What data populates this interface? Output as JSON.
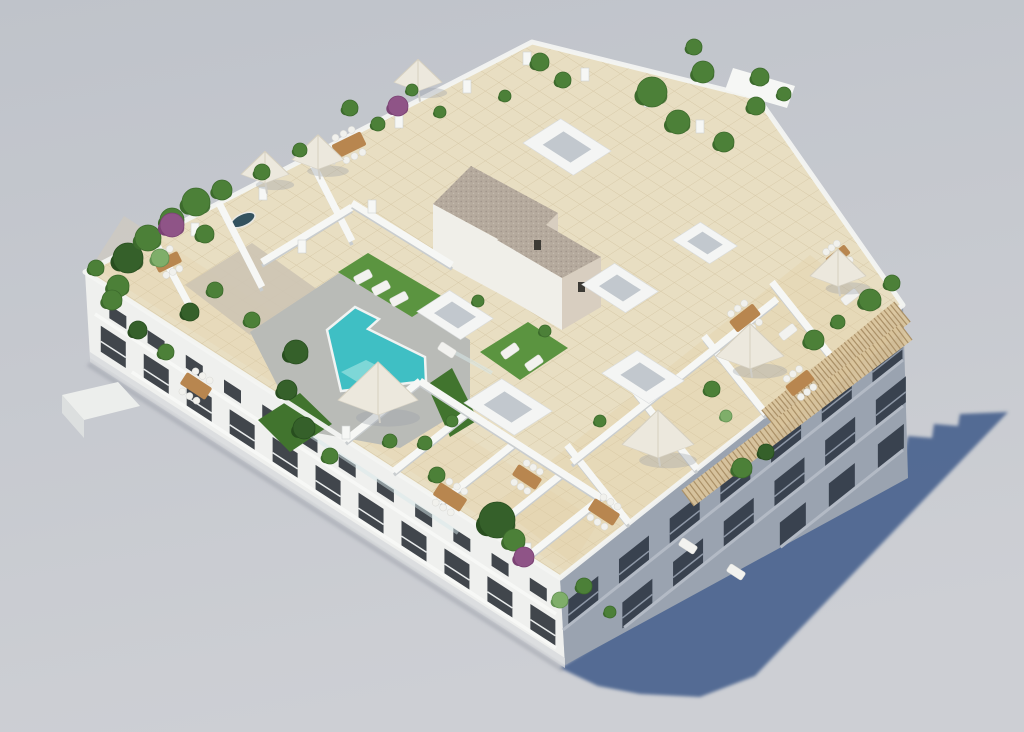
{
  "scene_meta": {
    "subject": "aerial 3d render of white apartment block with rooftop terraces and pool",
    "width": 1024,
    "height": 732
  },
  "colors": {
    "bg_top": "#bfc3ca",
    "bg_bottom": "#cdcfd4",
    "shadow": "#4d6590",
    "roof_tile": "#e8dec2",
    "tile_line": "#c7b48d",
    "front_band": "#e3d1a8",
    "right_band": "#e0cda2",
    "garden_gravel": "#cdc4b4",
    "deck": "#b9bbb7",
    "pool": "#3fbfc4",
    "pool_steps": "#8adada",
    "pool_coping": "#f1f3f2",
    "glass": "#d7e7e9",
    "grass": "#5b9440",
    "grass_dark": "#41742e",
    "wall_white": "#f6f7f5",
    "wall_shade": "#c9cdcf",
    "parapet": "#f3f4f2",
    "facade_front": "#eff0ee",
    "facade_se": "#9aa3b0",
    "facade_band_front": "#f7f8f6",
    "facade_band_se": "#b3bac5",
    "window_dark": "#41464c",
    "window_se": "#39424f",
    "rail_front": "#e9ecec",
    "rail_se": "#8d97a6",
    "plinth": "#d8dadd",
    "ao": "#8f949d",
    "gravel": "#b5aa9d",
    "gravel_dot": "#a0948a",
    "stair_wall": "#f0efe9",
    "stair_wall_warm": "#d8cec0",
    "stair_window": "#3c3a35",
    "pergola_wood": "#d9c49c",
    "pergola_slat": "#ab9168",
    "umbrella": "#ece8dd",
    "umbrella_rib": "#d6d0c0",
    "umbrella_shadow": "#9aa0a8",
    "table_wood": "#b8864f",
    "chair_white": "#f1f1ed",
    "lounger": "#f2f2ef",
    "skylight_top": "#f4f5f4",
    "skylight_inner": "#c2c8ce",
    "plant_green": "#4c8038",
    "plant_green_dark": "#3c6a2c",
    "plant_dark": "#35602a",
    "plant_darker": "#284e1f",
    "plant_light": "#7fae6a",
    "plant_light2": "#639253",
    "plant_purple": "#8f5487",
    "plant_purple2": "#7a4273",
    "trunk": "#7a5c3a",
    "jacuzzi": "#33525f",
    "west_balcony": "#eceeec",
    "west_balcony_side": "#dcdfdf"
  },
  "scene": {
    "walls": [
      [
        346,
        440,
        420,
        381
      ],
      [
        394,
        471,
        468,
        412
      ],
      [
        441,
        502,
        515,
        443
      ],
      [
        489,
        532,
        563,
        473
      ],
      [
        527,
        557,
        601,
        498
      ],
      [
        420,
        381,
        601,
        498
      ],
      [
        629,
        523,
        567,
        445
      ],
      [
        697,
        469,
        635,
        391
      ],
      [
        766,
        414,
        704,
        336
      ],
      [
        834,
        360,
        772,
        282
      ],
      [
        572,
        462,
        777,
        299
      ],
      [
        219,
        203,
        262,
        287
      ],
      [
        309,
        157,
        352,
        241
      ],
      [
        262,
        262,
        352,
        207
      ],
      [
        352,
        203,
        452,
        265
      ],
      [
        150,
        232,
        194,
        314
      ]
    ],
    "skylights": [
      [
        567,
        147,
        30
      ],
      [
        705,
        243,
        22
      ],
      [
        620,
        288,
        26
      ],
      [
        643,
        377,
        28
      ],
      [
        455,
        315,
        26
      ],
      [
        508,
        407,
        30
      ]
    ],
    "pillars": [
      [
        195,
        235
      ],
      [
        263,
        199
      ],
      [
        331,
        163
      ],
      [
        399,
        127
      ],
      [
        467,
        92
      ],
      [
        527,
        64
      ],
      [
        585,
        80
      ],
      [
        648,
        106
      ],
      [
        700,
        132
      ],
      [
        372,
        212
      ],
      [
        302,
        252
      ],
      [
        346,
        438
      ],
      [
        441,
        500
      ],
      [
        527,
        555
      ]
    ],
    "parasols": [
      [
        318,
        155,
        26
      ],
      [
        265,
        170,
        24
      ],
      [
        418,
        78,
        24
      ],
      [
        378,
        393,
        40
      ],
      [
        658,
        438,
        36
      ],
      [
        750,
        350,
        34
      ],
      [
        838,
        271,
        28
      ]
    ],
    "tables": [
      [
        349,
        145,
        32,
        15,
        -26
      ],
      [
        168,
        262,
        26,
        12,
        -26
      ],
      [
        196,
        386,
        30,
        14,
        33
      ],
      [
        450,
        497,
        32,
        15,
        33
      ],
      [
        527,
        477,
        28,
        13,
        33
      ],
      [
        604,
        512,
        30,
        14,
        33
      ],
      [
        745,
        318,
        30,
        14,
        -38
      ],
      [
        800,
        383,
        28,
        13,
        -38
      ],
      [
        838,
        256,
        24,
        11,
        -38
      ]
    ],
    "loungers": [
      [
        363,
        277,
        -28
      ],
      [
        381,
        288,
        -28
      ],
      [
        399,
        299,
        -28
      ],
      [
        510,
        351,
        -35
      ],
      [
        534,
        363,
        -35
      ],
      [
        788,
        332,
        -38
      ],
      [
        850,
        297,
        -38
      ],
      [
        688,
        546,
        33
      ],
      [
        736,
        572,
        33
      ],
      [
        447,
        350,
        33
      ]
    ],
    "plants": [
      [
        128,
        258,
        15,
        1
      ],
      [
        148,
        238,
        13,
        0
      ],
      [
        172,
        220,
        12,
        0
      ],
      [
        196,
        202,
        14,
        0
      ],
      [
        160,
        258,
        9,
        2
      ],
      [
        205,
        234,
        9,
        0
      ],
      [
        118,
        286,
        11,
        0
      ],
      [
        172,
        225,
        12,
        3
      ],
      [
        222,
        190,
        10,
        0
      ],
      [
        215,
        290,
        8,
        0
      ],
      [
        252,
        320,
        8,
        0
      ],
      [
        190,
        312,
        9,
        1
      ],
      [
        112,
        300,
        10,
        0
      ],
      [
        138,
        330,
        9,
        1
      ],
      [
        166,
        352,
        8,
        0
      ],
      [
        96,
        268,
        8,
        0
      ],
      [
        350,
        108,
        8,
        0
      ],
      [
        378,
        124,
        7,
        0
      ],
      [
        300,
        150,
        7,
        0
      ],
      [
        262,
        172,
        8,
        0
      ],
      [
        412,
        90,
        6,
        0
      ],
      [
        398,
        106,
        10,
        3
      ],
      [
        440,
        112,
        6,
        0
      ],
      [
        505,
        96,
        6,
        0
      ],
      [
        540,
        62,
        9,
        0
      ],
      [
        563,
        80,
        8,
        0
      ],
      [
        652,
        92,
        15,
        0
      ],
      [
        678,
        122,
        12,
        0
      ],
      [
        703,
        72,
        11,
        0
      ],
      [
        724,
        142,
        10,
        0
      ],
      [
        756,
        106,
        9,
        0
      ],
      [
        694,
        47,
        8,
        0
      ],
      [
        760,
        77,
        9,
        0
      ],
      [
        784,
        94,
        7,
        0
      ],
      [
        870,
        300,
        11,
        0
      ],
      [
        892,
        283,
        8,
        0
      ],
      [
        814,
        340,
        10,
        0
      ],
      [
        838,
        322,
        7,
        0
      ],
      [
        742,
        468,
        10,
        0
      ],
      [
        766,
        452,
        8,
        1
      ],
      [
        497,
        520,
        18,
        1
      ],
      [
        514,
        540,
        11,
        0
      ],
      [
        524,
        557,
        10,
        3
      ],
      [
        560,
        600,
        8,
        2
      ],
      [
        584,
        586,
        8,
        0
      ],
      [
        610,
        612,
        6,
        0
      ],
      [
        437,
        475,
        8,
        0
      ],
      [
        390,
        441,
        7,
        0
      ],
      [
        296,
        352,
        12,
        1
      ],
      [
        287,
        390,
        10,
        1
      ],
      [
        304,
        428,
        11,
        1
      ],
      [
        330,
        456,
        8,
        0
      ],
      [
        425,
        443,
        7,
        0
      ],
      [
        452,
        421,
        6,
        0
      ],
      [
        545,
        331,
        6,
        0
      ],
      [
        600,
        421,
        6,
        0
      ],
      [
        478,
        301,
        6,
        0
      ],
      [
        712,
        389,
        8,
        0
      ],
      [
        726,
        416,
        6,
        2
      ]
    ],
    "facade_rows": [
      {
        "p1": [
          95,
          284
        ],
        "p2": [
          552,
          580
        ],
        "t0": 0.05,
        "t1": 0.97,
        "n": 12,
        "dy": 12,
        "w": 17,
        "h": 13,
        "k": 0.648,
        "fill": "window_dark",
        "rail": ""
      },
      {
        "p1": [
          95,
          284
        ],
        "p2": [
          552,
          580
        ],
        "t0": 0.04,
        "t1": 0.98,
        "n": 11,
        "dy": 38,
        "w": 25,
        "h": 26,
        "k": 0.648,
        "fill": "window_dark",
        "rail": "rail_front"
      },
      {
        "p1": [
          563,
          580
        ],
        "p2": [
          901,
          310
        ],
        "t0": 0.06,
        "t1": 0.96,
        "n": 7,
        "dy": 24,
        "w": 30,
        "h": 26,
        "k": -0.79,
        "fill": "window_se",
        "rail": "rail_se"
      },
      {
        "p1": [
          563,
          580
        ],
        "p2": [
          901,
          310
        ],
        "t0": 0.22,
        "t1": 0.97,
        "n": 6,
        "dy": 70,
        "w": 30,
        "h": 26,
        "k": -0.79,
        "fill": "window_se",
        "rail": "rail_se"
      },
      {
        "p1": [
          563,
          580
        ],
        "p2": [
          901,
          310
        ],
        "t0": 0.68,
        "t1": 0.97,
        "n": 3,
        "dy": 116,
        "w": 26,
        "h": 24,
        "k": -0.79,
        "fill": "window_se",
        "rail": ""
      }
    ],
    "bands": [
      {
        "p1": [
          95,
          284
        ],
        "p2": [
          556,
          584
        ],
        "dy": 30,
        "w": 3.5,
        "color": "facade_band_front",
        "t0": 0,
        "t1": 1
      },
      {
        "p1": [
          95,
          284
        ],
        "p2": [
          556,
          584
        ],
        "dy": 64,
        "w": 3.5,
        "color": "facade_band_front",
        "t0": 0.08,
        "t1": 1
      },
      {
        "p1": [
          563,
          582
        ],
        "p2": [
          903,
          312
        ],
        "dy": 48,
        "w": 3,
        "color": "facade_band_se",
        "t0": 0,
        "t1": 1
      },
      {
        "p1": [
          563,
          582
        ],
        "p2": [
          903,
          312
        ],
        "dy": 94,
        "w": 3,
        "color": "facade_band_se",
        "t0": 0.18,
        "t1": 1
      },
      {
        "p1": [
          563,
          582
        ],
        "p2": [
          903,
          312
        ],
        "dy": 138,
        "w": 3,
        "color": "facade_band_se",
        "t0": 0.64,
        "t1": 1
      }
    ],
    "pergolas": [
      [
        770,
        420,
        902,
        312,
        26,
        40
      ],
      [
        688,
        498,
        906,
        332,
        20,
        56
      ]
    ]
  }
}
